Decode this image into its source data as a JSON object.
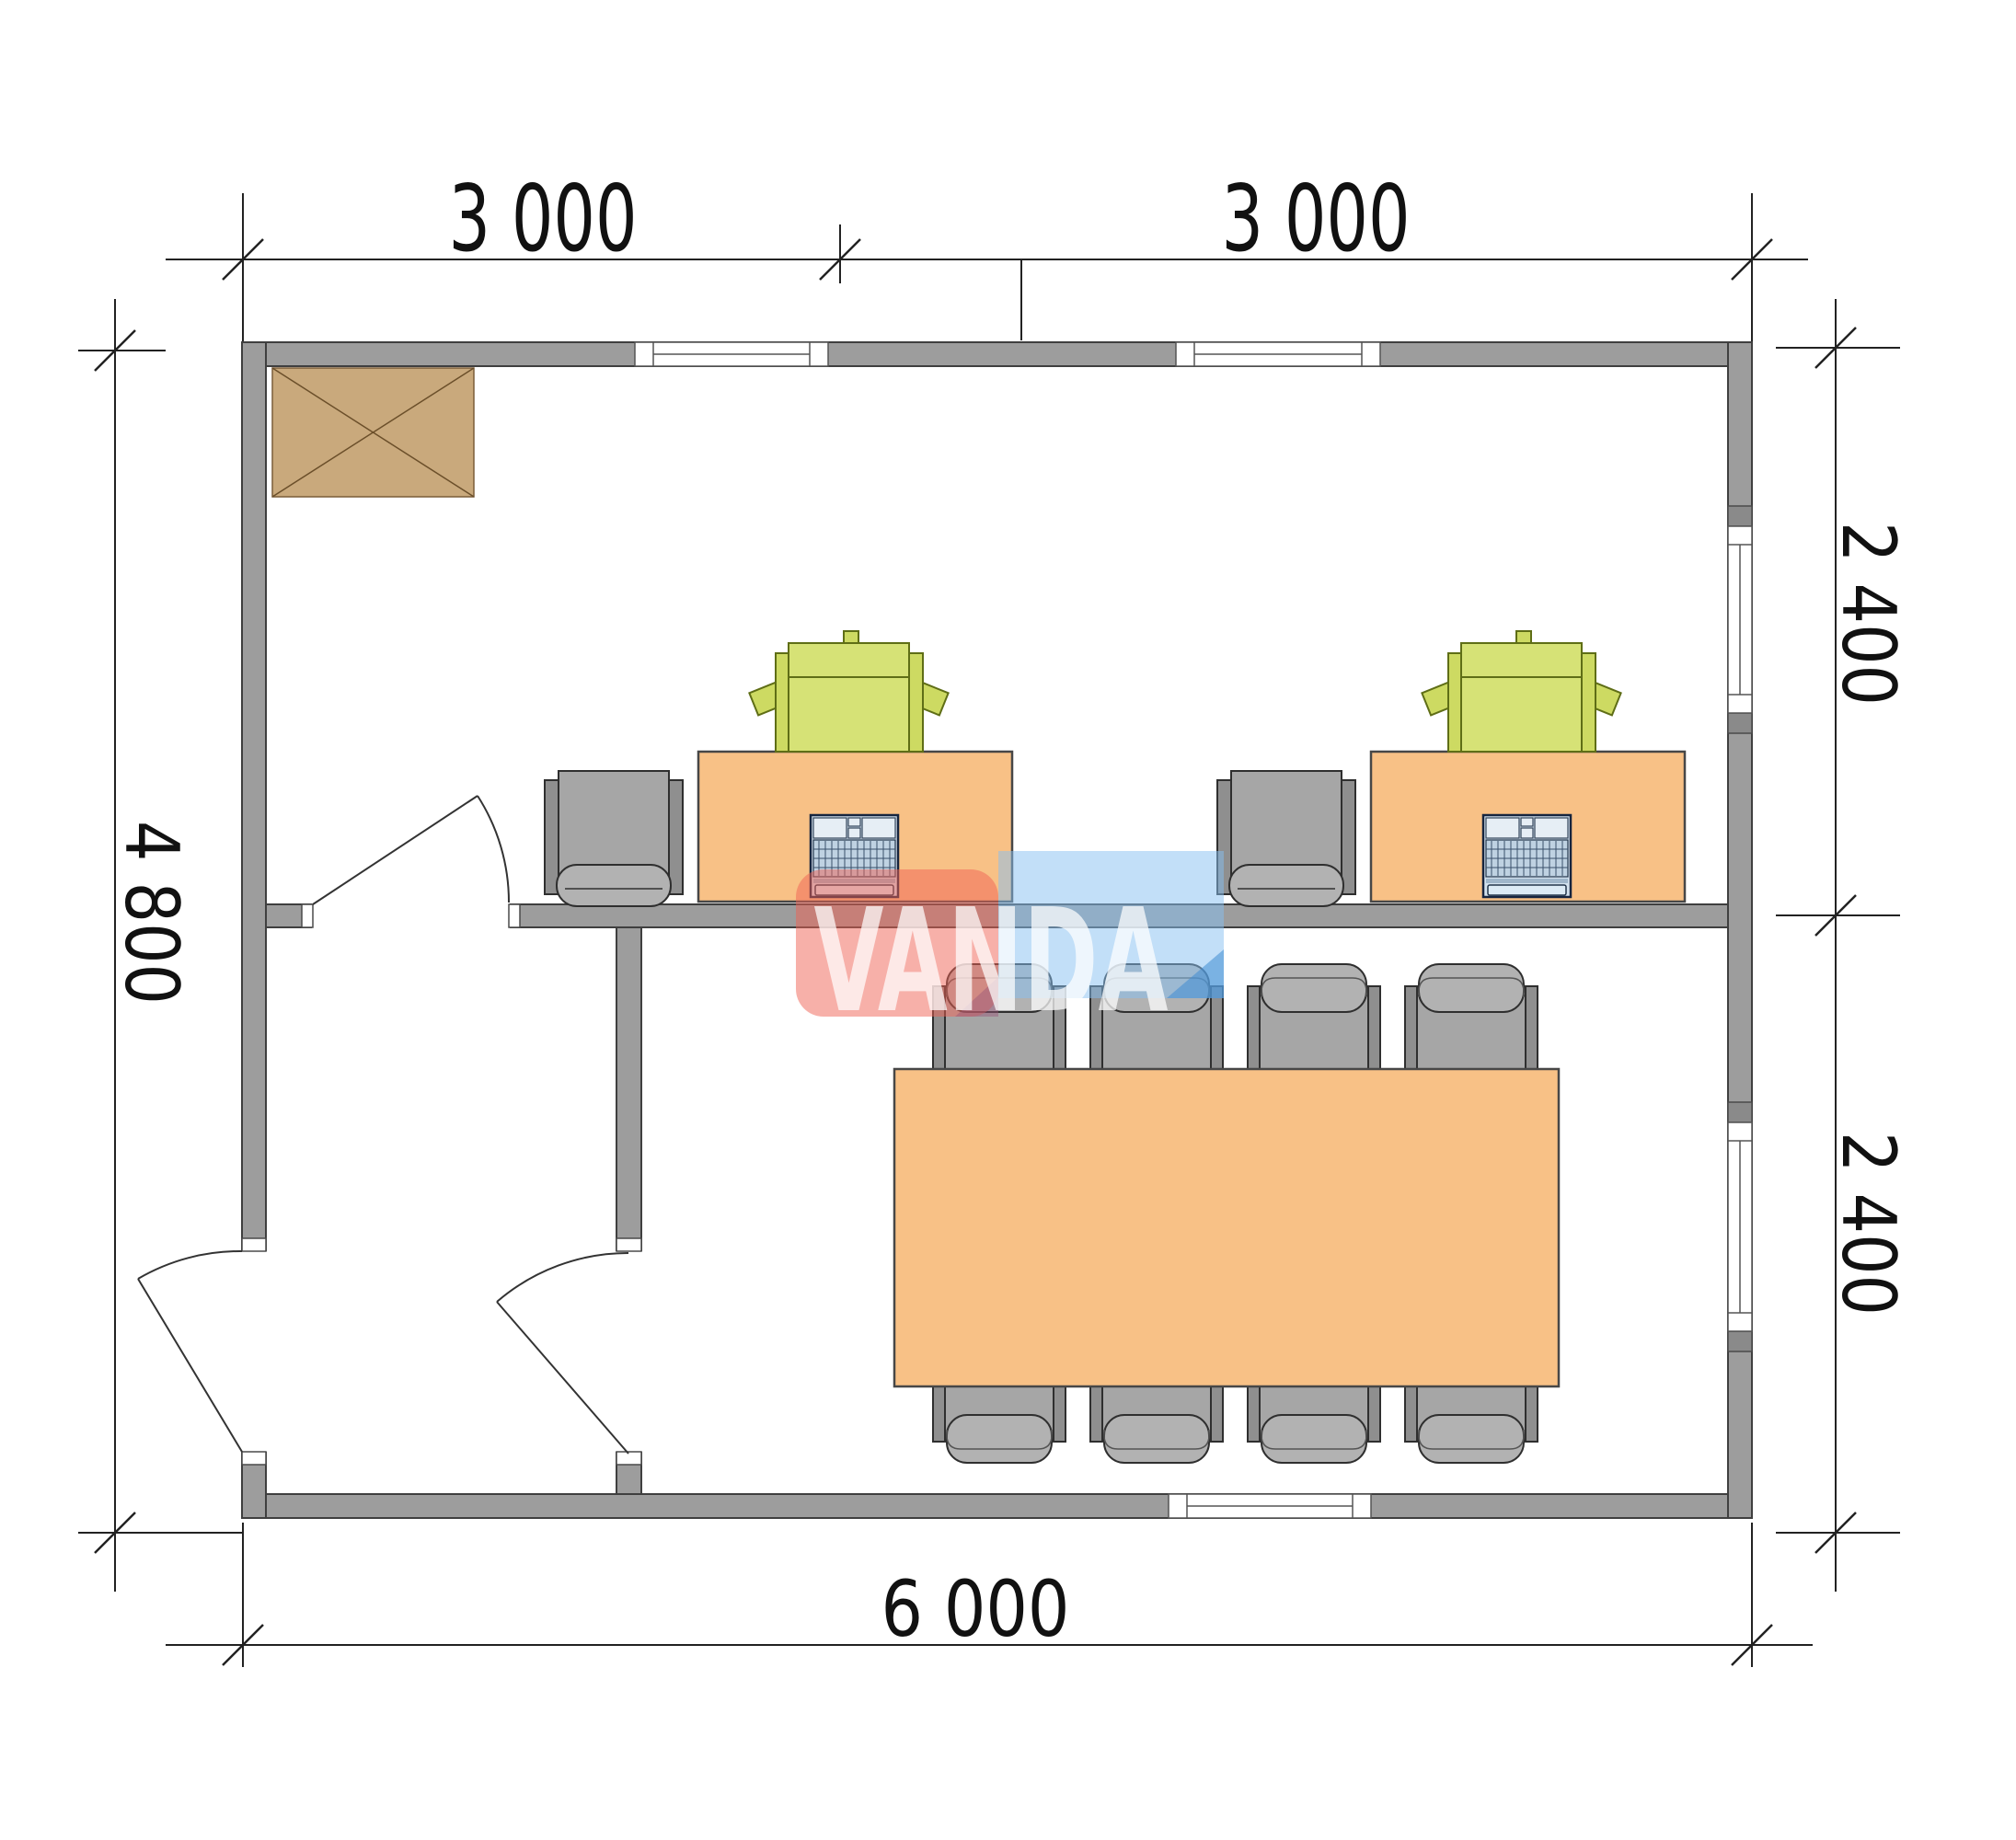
{
  "drawing": {
    "type": "floor-plan",
    "dimensions": {
      "top_left": "3 000",
      "top_right": "3 000",
      "left": "4 800",
      "right_top": "2 400",
      "right_bottom": "2 400",
      "bottom": "6 000"
    },
    "watermark": {
      "text": "VANDA",
      "red_block_color": "#f06153",
      "blue_block_color": "#86c0f2",
      "dark_blue_accent": "#408cd2",
      "text_color": "#ffffff"
    },
    "colors": {
      "wall": "#9d9d9d",
      "wall_outline": "#3f3f3f",
      "desk_and_table": "#f8c186",
      "chair": "#a6a6a6",
      "printer": "#d6e276",
      "laptop": "#d3e2ee",
      "storage_box": "#c9a97c",
      "dimension_ink": "#222222",
      "background": "#ffffff"
    },
    "rooms": {
      "office_desks": 2,
      "meeting_chairs": 8,
      "doors": 3,
      "windows": 5
    }
  }
}
